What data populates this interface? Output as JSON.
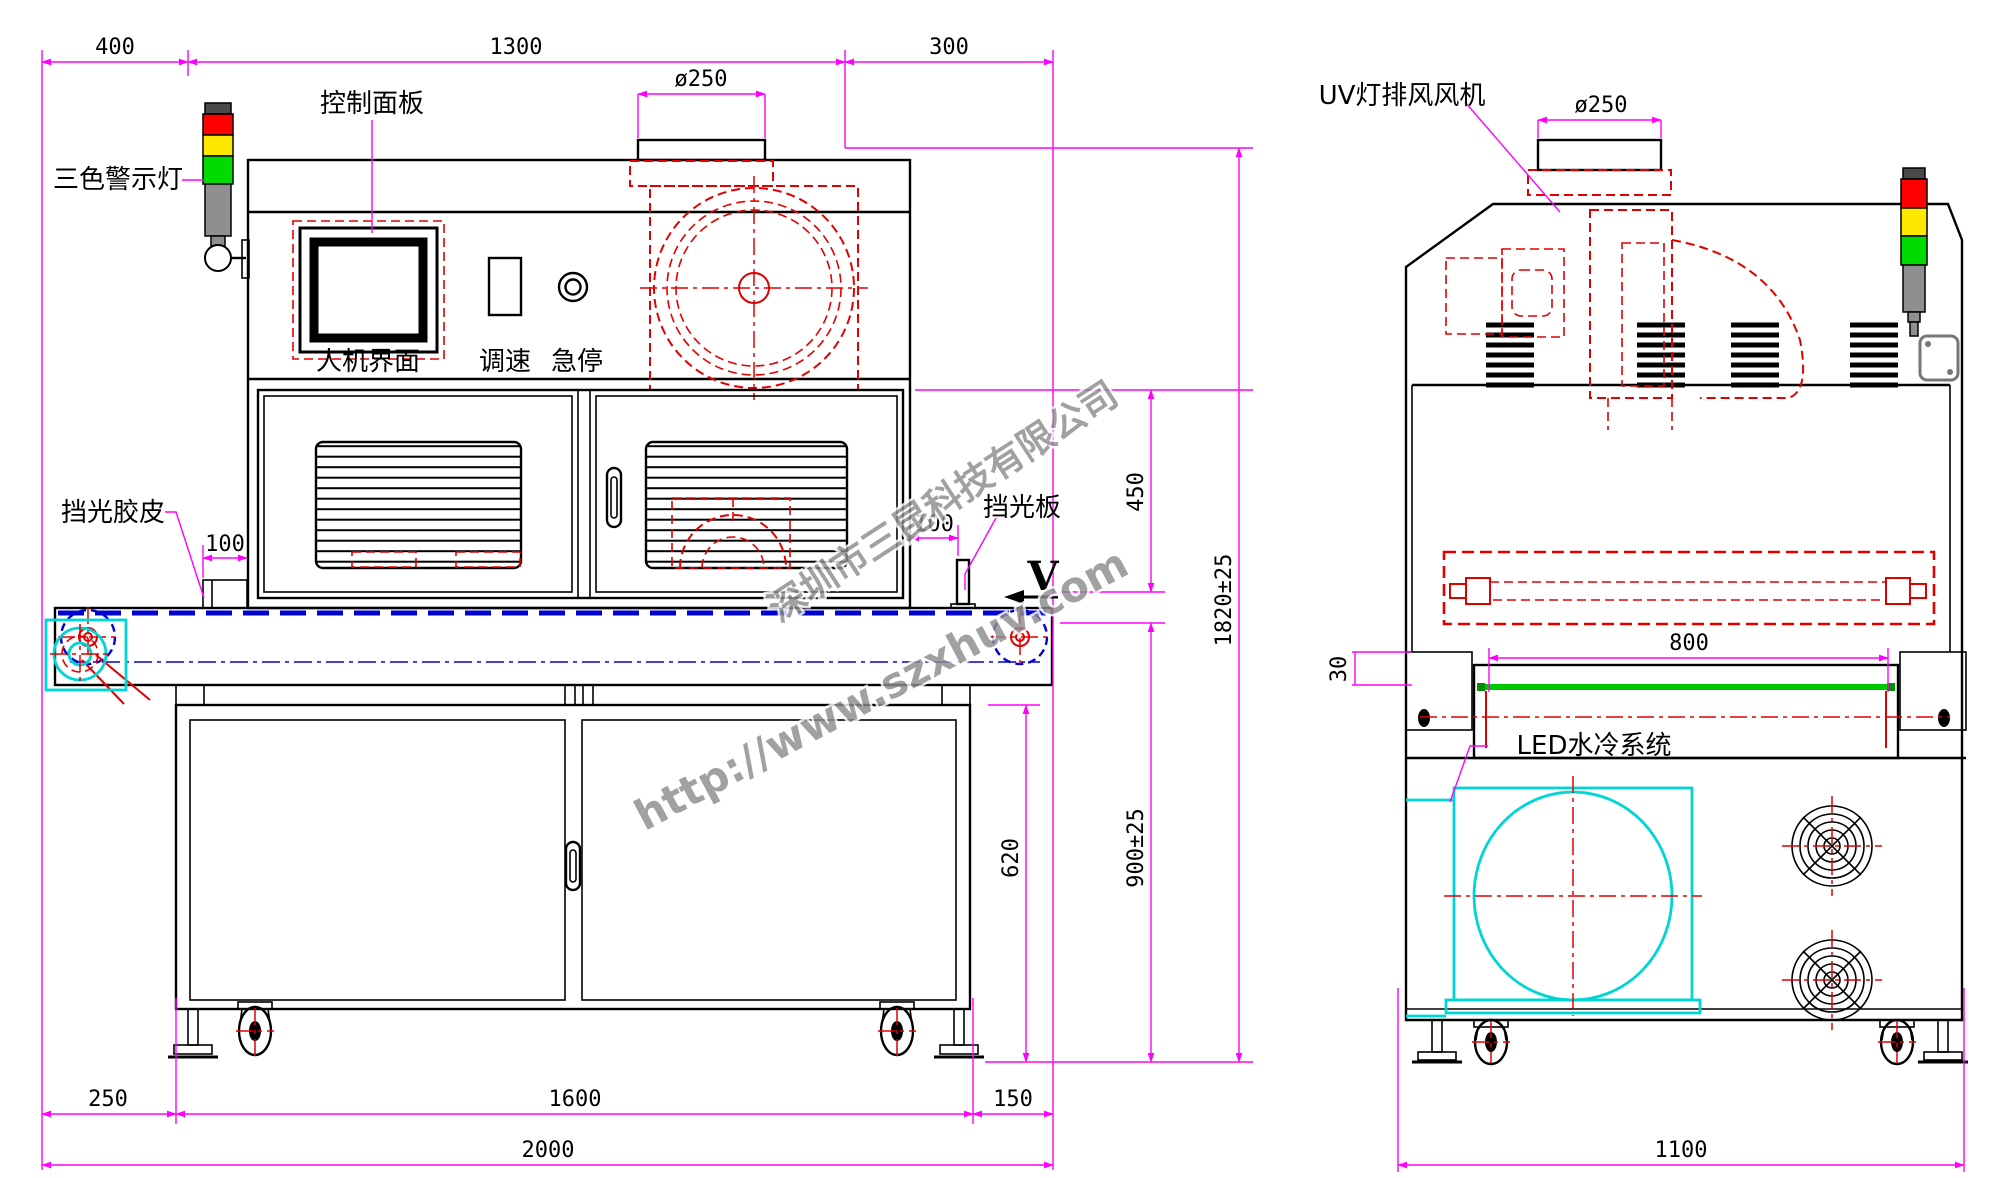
{
  "front": {
    "labels": {
      "warning_light": "三色警示灯",
      "control_panel": "控制面板",
      "hmi": "人机界面",
      "speed_knob": "调速",
      "emergency_stop": "急停",
      "light_shield_rubber": "挡光胶皮",
      "light_shield_plate": "挡光板",
      "direction_arrow": "V"
    },
    "dims": {
      "top_left": "400",
      "top_center": "1300",
      "top_right": "300",
      "duct_diameter": "ø250",
      "shield_left_offset": "100",
      "shield_right_offset": "100",
      "lamp_to_belt": "450",
      "total_height": "1820±25",
      "belt_height": "900±25",
      "stand_height": "620",
      "bottom_left": "250",
      "bottom_center": "1600",
      "bottom_right": "150",
      "total_length": "2000"
    }
  },
  "side": {
    "labels": {
      "exhaust_fan": "UV灯排风风机",
      "water_cooling": "LED水冷系统"
    },
    "dims": {
      "duct_diameter": "ø250",
      "cure_width": "800",
      "belt_step": "30",
      "total_width": "1100"
    }
  },
  "watermark": {
    "company": "深圳市三昆科技有限公司",
    "website": "http://www.szxhuv.com"
  },
  "colors": {
    "dimension": "#ff00ff",
    "hidden_detail": "#e10000",
    "belt": "#0000d0",
    "cooling": "#00d5d5",
    "belt_side_view": "#00c800",
    "lamp_red": "#ff0000",
    "lamp_yellow": "#ffe800",
    "lamp_green": "#00dc00",
    "lamp_gray": "#8f8f8f",
    "outline": "#000000"
  }
}
